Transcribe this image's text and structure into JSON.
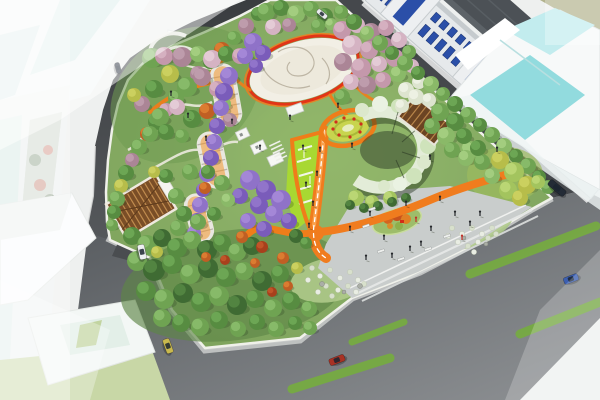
{
  "meta": {
    "subject": "Aerial bird's-eye architectural rendering of an urban pocket-park master plan with orange pathways, flowering tree groves, a central paved plaza and surrounding streets and buildings",
    "no_visible_text": true
  },
  "palette": {
    "road_asphalt_dark": "#3a3d40",
    "road_asphalt_light": "#8b8f92",
    "park_green_base": "#7ba05a",
    "lawn_lime": "#a8d832",
    "path_orange": "#f07c1e",
    "plaza_ring_red": "#e23517",
    "plaza_paving_white": "#f2efe5",
    "lower_plaza_gray": "#c9cdcc",
    "wisteria_purple": "#8f72c8",
    "cherry_pink": "#c498ab",
    "glass_teal": "#86d7da",
    "lane_stripe_green": "#76ad3f",
    "window_blue": "#2b4fa8",
    "canopy_brown": "#7a4e27",
    "flower_circle_yellow": "#c8d44e"
  },
  "scene": {
    "tree_colors": {
      "G1": [
        "#3f6b33",
        "#548743"
      ],
      "G2": [
        "#578c41",
        "#6fa957"
      ],
      "G3": [
        "#6fa352",
        "#8abc6b"
      ],
      "G4": [
        "#8ab968",
        "#a5cf82"
      ],
      "LG": [
        "#a3c45e",
        "#bdd877"
      ],
      "YG": [
        "#b7bd4a",
        "#cdd162"
      ],
      "OR": [
        "#c05f24",
        "#de7f33"
      ],
      "RD": [
        "#a8401c",
        "#c3562a"
      ],
      "PK": [
        "#c498ab",
        "#d7b2c2"
      ],
      "PK2": [
        "#d5b3c3",
        "#e5cdd8"
      ],
      "MV": [
        "#ab8596",
        "#c09fae"
      ],
      "PU": [
        "#8f72c8",
        "#a68ad8"
      ],
      "PU2": [
        "#7a5cba",
        "#9377cc"
      ],
      "WH": [
        "#dde4cf",
        "#eef2e4"
      ]
    },
    "trees": [
      [
        258,
        14,
        7,
        "G2"
      ],
      [
        246,
        26,
        8,
        "MV"
      ],
      [
        234,
        38,
        7,
        "G3"
      ],
      [
        222,
        50,
        8,
        "OR"
      ],
      [
        210,
        62,
        7,
        "G2"
      ],
      [
        198,
        74,
        8,
        "MV"
      ],
      [
        187,
        86,
        7,
        "YG"
      ],
      [
        176,
        98,
        8,
        "G3"
      ],
      [
        166,
        110,
        7,
        "PK"
      ],
      [
        156,
        122,
        8,
        "G2"
      ],
      [
        147,
        134,
        7,
        "OR"
      ],
      [
        139,
        147,
        8,
        "G3"
      ],
      [
        132,
        160,
        7,
        "MV"
      ],
      [
        126,
        173,
        8,
        "G2"
      ],
      [
        121,
        186,
        7,
        "YG"
      ],
      [
        117,
        199,
        8,
        "G3"
      ],
      [
        114,
        212,
        7,
        "G2"
      ],
      [
        112,
        225,
        6,
        "G3"
      ],
      [
        152,
        58,
        10,
        "G3"
      ],
      [
        164,
        56,
        9,
        "PK"
      ],
      [
        182,
        57,
        10,
        "MV"
      ],
      [
        198,
        54,
        8,
        "G4"
      ],
      [
        212,
        59,
        9,
        "PK2"
      ],
      [
        226,
        54,
        8,
        "G2"
      ],
      [
        240,
        56,
        8,
        "PK"
      ],
      [
        170,
        74,
        9,
        "YG"
      ],
      [
        187,
        87,
        10,
        "G3"
      ],
      [
        202,
        77,
        9,
        "MV"
      ],
      [
        217,
        89,
        8,
        "PK"
      ],
      [
        154,
        89,
        9,
        "G2"
      ],
      [
        142,
        104,
        8,
        "MV"
      ],
      [
        160,
        117,
        9,
        "G3"
      ],
      [
        177,
        107,
        8,
        "PK2"
      ],
      [
        192,
        119,
        9,
        "G2"
      ],
      [
        207,
        111,
        8,
        "OR"
      ],
      [
        224,
        104,
        7,
        "G4"
      ],
      [
        150,
        134,
        8,
        "G3"
      ],
      [
        134,
        95,
        7,
        "YG"
      ],
      [
        230,
        120,
        7,
        "MV"
      ],
      [
        166,
        132,
        8,
        "G2"
      ],
      [
        182,
        136,
        7,
        "G3"
      ],
      [
        266,
        12,
        9,
        "G3"
      ],
      [
        281,
        8,
        8,
        "G2"
      ],
      [
        296,
        14,
        9,
        "G4"
      ],
      [
        311,
        9,
        8,
        "G3"
      ],
      [
        325,
        16,
        8,
        "G2"
      ],
      [
        273,
        27,
        8,
        "PK2"
      ],
      [
        289,
        25,
        7,
        "MV"
      ],
      [
        318,
        26,
        7,
        "G3"
      ],
      [
        331,
        24,
        6,
        "G4"
      ],
      [
        253,
        42,
        9,
        "PU"
      ],
      [
        263,
        53,
        8,
        "PU2"
      ],
      [
        245,
        56,
        8,
        "PU"
      ],
      [
        256,
        66,
        7,
        "PU2"
      ],
      [
        229,
        76,
        9,
        "PU"
      ],
      [
        224,
        92,
        9,
        "PU2"
      ],
      [
        221,
        108,
        8,
        "PU"
      ],
      [
        217,
        126,
        8,
        "PU2"
      ],
      [
        214,
        142,
        8,
        "PU"
      ],
      [
        211,
        158,
        8,
        "PU2"
      ],
      [
        207,
        174,
        8,
        "PU"
      ],
      [
        203,
        190,
        7,
        "PU2"
      ],
      [
        200,
        205,
        8,
        "PU"
      ],
      [
        197,
        220,
        7,
        "PU2"
      ],
      [
        194,
        233,
        7,
        "PU"
      ],
      [
        250,
        180,
        10,
        "PU"
      ],
      [
        266,
        190,
        10,
        "PU2"
      ],
      [
        281,
        200,
        10,
        "PU"
      ],
      [
        259,
        205,
        9,
        "PU2"
      ],
      [
        274,
        214,
        9,
        "PU"
      ],
      [
        289,
        221,
        8,
        "PU2"
      ],
      [
        248,
        221,
        8,
        "PU"
      ],
      [
        264,
        229,
        8,
        "PU2"
      ],
      [
        240,
        196,
        8,
        "PU2"
      ],
      [
        342,
        30,
        9,
        "PK"
      ],
      [
        357,
        25,
        8,
        "PK2"
      ],
      [
        371,
        32,
        9,
        "MV"
      ],
      [
        386,
        28,
        8,
        "PK"
      ],
      [
        352,
        45,
        10,
        "PK2"
      ],
      [
        369,
        50,
        9,
        "PK"
      ],
      [
        385,
        45,
        8,
        "MV"
      ],
      [
        399,
        40,
        8,
        "PK2"
      ],
      [
        343,
        62,
        9,
        "MV"
      ],
      [
        361,
        68,
        10,
        "PK"
      ],
      [
        379,
        64,
        8,
        "PK2"
      ],
      [
        395,
        58,
        9,
        "PK"
      ],
      [
        409,
        52,
        7,
        "G3"
      ],
      [
        351,
        82,
        8,
        "PK2"
      ],
      [
        367,
        85,
        9,
        "MV"
      ],
      [
        383,
        80,
        8,
        "PK"
      ],
      [
        398,
        74,
        8,
        "G4"
      ],
      [
        412,
        66,
        7,
        "PK2"
      ],
      [
        342,
        97,
        8,
        "G3"
      ],
      [
        406,
        90,
        8,
        "WH"
      ],
      [
        419,
        82,
        7,
        "WH"
      ],
      [
        416,
        97,
        8,
        "WH"
      ],
      [
        429,
        100,
        7,
        "WH"
      ],
      [
        402,
        106,
        7,
        "WH"
      ],
      [
        341,
        12,
        7,
        "G3"
      ],
      [
        354,
        22,
        8,
        "G2"
      ],
      [
        367,
        33,
        7,
        "G4"
      ],
      [
        380,
        43,
        8,
        "G3"
      ],
      [
        392,
        53,
        7,
        "G2"
      ],
      [
        405,
        63,
        8,
        "G3"
      ],
      [
        418,
        73,
        7,
        "G2"
      ],
      [
        431,
        84,
        8,
        "G4"
      ],
      [
        443,
        94,
        7,
        "G3"
      ],
      [
        455,
        104,
        8,
        "G2"
      ],
      [
        468,
        115,
        8,
        "G3"
      ],
      [
        480,
        125,
        7,
        "G2"
      ],
      [
        492,
        135,
        8,
        "G3"
      ],
      [
        504,
        146,
        8,
        "G4"
      ],
      [
        516,
        156,
        7,
        "G2"
      ],
      [
        528,
        166,
        8,
        "G3"
      ],
      [
        539,
        177,
        7,
        "G2"
      ],
      [
        548,
        187,
        7,
        "G3"
      ],
      [
        500,
        160,
        9,
        "YG"
      ],
      [
        514,
        172,
        10,
        "LG"
      ],
      [
        527,
        185,
        9,
        "YG"
      ],
      [
        492,
        176,
        8,
        "G4"
      ],
      [
        508,
        190,
        9,
        "LG"
      ],
      [
        520,
        198,
        8,
        "YG"
      ],
      [
        482,
        162,
        8,
        "G3"
      ],
      [
        470,
        150,
        9,
        "G4"
      ],
      [
        538,
        182,
        7,
        "LG"
      ],
      [
        440,
        112,
        9,
        "G3"
      ],
      [
        455,
        122,
        9,
        "G2"
      ],
      [
        446,
        136,
        9,
        "G4"
      ],
      [
        432,
        126,
        8,
        "G3"
      ],
      [
        464,
        136,
        8,
        "G2"
      ],
      [
        452,
        150,
        8,
        "G3"
      ],
      [
        466,
        158,
        8,
        "G4"
      ],
      [
        478,
        148,
        8,
        "G2"
      ],
      [
        296,
        236,
        7,
        "G1"
      ],
      [
        306,
        243,
        6,
        "G2"
      ],
      [
        132,
        236,
        9,
        "G2"
      ],
      [
        147,
        245,
        10,
        "G3"
      ],
      [
        162,
        238,
        9,
        "G1"
      ],
      [
        177,
        248,
        10,
        "G2"
      ],
      [
        192,
        240,
        9,
        "G3"
      ],
      [
        207,
        250,
        10,
        "G1"
      ],
      [
        222,
        243,
        9,
        "G2"
      ],
      [
        237,
        252,
        9,
        "G3"
      ],
      [
        252,
        246,
        9,
        "G1"
      ],
      [
        137,
        261,
        10,
        "G3"
      ],
      [
        154,
        270,
        11,
        "G1"
      ],
      [
        172,
        264,
        10,
        "G2"
      ],
      [
        190,
        274,
        10,
        "G3"
      ],
      [
        208,
        268,
        10,
        "G1"
      ],
      [
        226,
        277,
        10,
        "G2"
      ],
      [
        244,
        271,
        9,
        "G3"
      ],
      [
        262,
        281,
        10,
        "G1"
      ],
      [
        280,
        274,
        9,
        "G2"
      ],
      [
        146,
        291,
        10,
        "G2"
      ],
      [
        164,
        299,
        10,
        "G3"
      ],
      [
        183,
        293,
        10,
        "G1"
      ],
      [
        201,
        302,
        10,
        "G2"
      ],
      [
        219,
        296,
        10,
        "G3"
      ],
      [
        237,
        305,
        10,
        "G1"
      ],
      [
        255,
        299,
        9,
        "G2"
      ],
      [
        273,
        308,
        9,
        "G3"
      ],
      [
        291,
        301,
        9,
        "G2"
      ],
      [
        309,
        309,
        8,
        "G3"
      ],
      [
        162,
        318,
        9,
        "G3"
      ],
      [
        181,
        323,
        9,
        "G2"
      ],
      [
        200,
        327,
        9,
        "G3"
      ],
      [
        219,
        320,
        9,
        "G2"
      ],
      [
        238,
        329,
        8,
        "G3"
      ],
      [
        257,
        322,
        8,
        "G2"
      ],
      [
        276,
        329,
        8,
        "G3"
      ],
      [
        295,
        323,
        7,
        "G2"
      ],
      [
        310,
        328,
        7,
        "G3"
      ],
      [
        242,
        237,
        6,
        "OR"
      ],
      [
        262,
        247,
        6,
        "RD"
      ],
      [
        283,
        258,
        6,
        "OR"
      ],
      [
        255,
        263,
        5,
        "OR"
      ],
      [
        225,
        260,
        5,
        "RD"
      ],
      [
        206,
        257,
        5,
        "OR"
      ],
      [
        157,
        252,
        6,
        "YG"
      ],
      [
        297,
        268,
        6,
        "YG"
      ],
      [
        288,
        286,
        5,
        "OR"
      ],
      [
        272,
        292,
        5,
        "RD"
      ],
      [
        176,
        196,
        8,
        "G3"
      ],
      [
        190,
        172,
        8,
        "G3"
      ],
      [
        208,
        172,
        7,
        "G2"
      ],
      [
        222,
        183,
        8,
        "G3"
      ],
      [
        166,
        176,
        7,
        "G2"
      ],
      [
        154,
        172,
        6,
        "YG"
      ],
      [
        205,
        188,
        6,
        "OR"
      ],
      [
        184,
        214,
        8,
        "G2"
      ],
      [
        198,
        222,
        8,
        "G3"
      ],
      [
        214,
        214,
        7,
        "G2"
      ],
      [
        228,
        200,
        7,
        "G4"
      ],
      [
        178,
        228,
        8,
        "G3"
      ],
      [
        356,
        198,
        8,
        "LG"
      ],
      [
        372,
        202,
        7,
        "LG"
      ],
      [
        390,
        198,
        7,
        "LG"
      ],
      [
        350,
        205,
        5,
        "G1"
      ],
      [
        364,
        208,
        5,
        "G1"
      ],
      [
        378,
        206,
        5,
        "G1"
      ],
      [
        392,
        202,
        5,
        "G1"
      ],
      [
        406,
        198,
        5,
        "G1"
      ]
    ],
    "cars": [
      {
        "x": 142,
        "y": 252,
        "rot": 78,
        "l": 15,
        "w": 7,
        "color": "#eef0f2"
      },
      {
        "x": 118,
        "y": 68,
        "rot": 75,
        "l": 11,
        "w": 5,
        "color": "#2a3240"
      },
      {
        "x": 168,
        "y": 346,
        "rot": 70,
        "l": 15,
        "w": 7,
        "color": "#c9b94e"
      },
      {
        "x": 337,
        "y": 360,
        "rot": -21,
        "l": 16,
        "w": 7,
        "color": "#a83224"
      },
      {
        "x": 571,
        "y": 279,
        "rot": -21,
        "l": 15,
        "w": 7,
        "color": "#3c5fb0"
      },
      {
        "x": 557,
        "y": 188,
        "rot": 40,
        "l": 20,
        "w": 7,
        "color": "#232b36"
      },
      {
        "x": 322,
        "y": 14,
        "rot": 40,
        "l": 12,
        "w": 5,
        "color": "#e9ebed"
      }
    ],
    "lane_stripes": [
      [
        470,
        274,
        596,
        226,
        9
      ],
      [
        520,
        334,
        600,
        302,
        9
      ],
      [
        292,
        389,
        390,
        358,
        9
      ],
      [
        352,
        342,
        404,
        322,
        7
      ]
    ],
    "people": [
      [
        370,
        216
      ],
      [
        384,
        240
      ],
      [
        410,
        251
      ],
      [
        431,
        231
      ],
      [
        455,
        216
      ],
      [
        470,
        226
      ],
      [
        366,
        260
      ],
      [
        406,
        206
      ],
      [
        440,
        201
      ],
      [
        480,
        216
      ],
      [
        350,
        231
      ],
      [
        421,
        246
      ],
      [
        392,
        258
      ],
      [
        462,
        240,
        "#c03028"
      ],
      [
        416,
        222,
        "#c03028"
      ],
      [
        313,
        206
      ],
      [
        309,
        228
      ],
      [
        317,
        176
      ],
      [
        320,
        152
      ],
      [
        303,
        150
      ],
      [
        306,
        187
      ],
      [
        338,
        108
      ],
      [
        352,
        148
      ],
      [
        188,
        118
      ],
      [
        171,
        96
      ],
      [
        206,
        141
      ],
      [
        232,
        124
      ],
      [
        260,
        150
      ],
      [
        290,
        120
      ],
      [
        497,
        152
      ],
      [
        430,
        160
      ]
    ],
    "benches": [
      [
        366,
        226
      ],
      [
        381,
        251
      ],
      [
        401,
        259
      ],
      [
        428,
        249
      ],
      [
        447,
        236
      ],
      [
        372,
        209
      ]
    ],
    "shrubs": [
      [
        312,
        268
      ],
      [
        320,
        276
      ],
      [
        330,
        270
      ],
      [
        340,
        278
      ],
      [
        350,
        272
      ],
      [
        358,
        280
      ],
      [
        326,
        286
      ],
      [
        338,
        290
      ],
      [
        348,
        286
      ],
      [
        318,
        292
      ],
      [
        332,
        296
      ],
      [
        356,
        292
      ],
      [
        364,
        284
      ],
      [
        308,
        280
      ],
      [
        452,
        228
      ],
      [
        462,
        234
      ],
      [
        472,
        228
      ],
      [
        482,
        234
      ],
      [
        492,
        228
      ],
      [
        458,
        242
      ],
      [
        468,
        246
      ],
      [
        478,
        242
      ],
      [
        488,
        238
      ],
      [
        448,
        236
      ],
      [
        496,
        234
      ],
      [
        474,
        252
      ]
    ],
    "rocks": [
      [
        322,
        284,
        2.5
      ],
      [
        344,
        292,
        2
      ],
      [
        360,
        286,
        2.5
      ],
      [
        464,
        238,
        2
      ],
      [
        486,
        244,
        2
      ]
    ],
    "row_building": {
      "window_count": 26,
      "window_gap": 11,
      "window_color": "#2b4fa8",
      "tower_skips": [
        [
          18,
          60
        ],
        [
          114,
          156
        ],
        [
          210,
          252
        ]
      ]
    }
  }
}
